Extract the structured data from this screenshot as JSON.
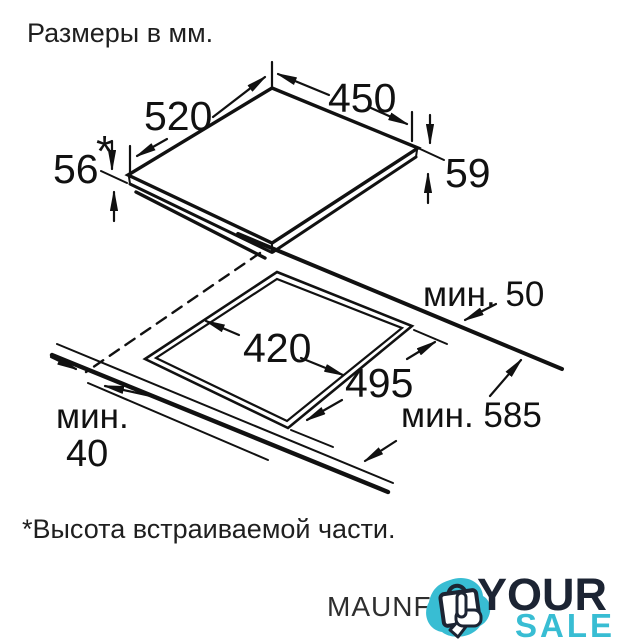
{
  "title": "Размеры в мм.",
  "diagram": {
    "cooktop": {
      "dim_depth": "520",
      "dim_width": "450",
      "dim_height_left": "56",
      "dim_height_left_star": "*",
      "dim_height_right": "59"
    },
    "cutout": {
      "dim_width": "420",
      "dim_depth": "495",
      "dim_rear_clearance": "мин. 50",
      "dim_total_depth": "мин. 585",
      "dim_front_clearance_word": "мин.",
      "dim_front_clearance_value": "40"
    }
  },
  "footnote": "*Высота встраиваемой части.",
  "brand_text": "MAUNFI",
  "logo": {
    "word_top": "YOUR",
    "word_bottom": "SALE",
    "icon": "shopping-bag-click-icon"
  },
  "colors": {
    "line": "#111111",
    "teal": "#38bdd3",
    "navy": "#1c2433",
    "background": "#ffffff"
  }
}
